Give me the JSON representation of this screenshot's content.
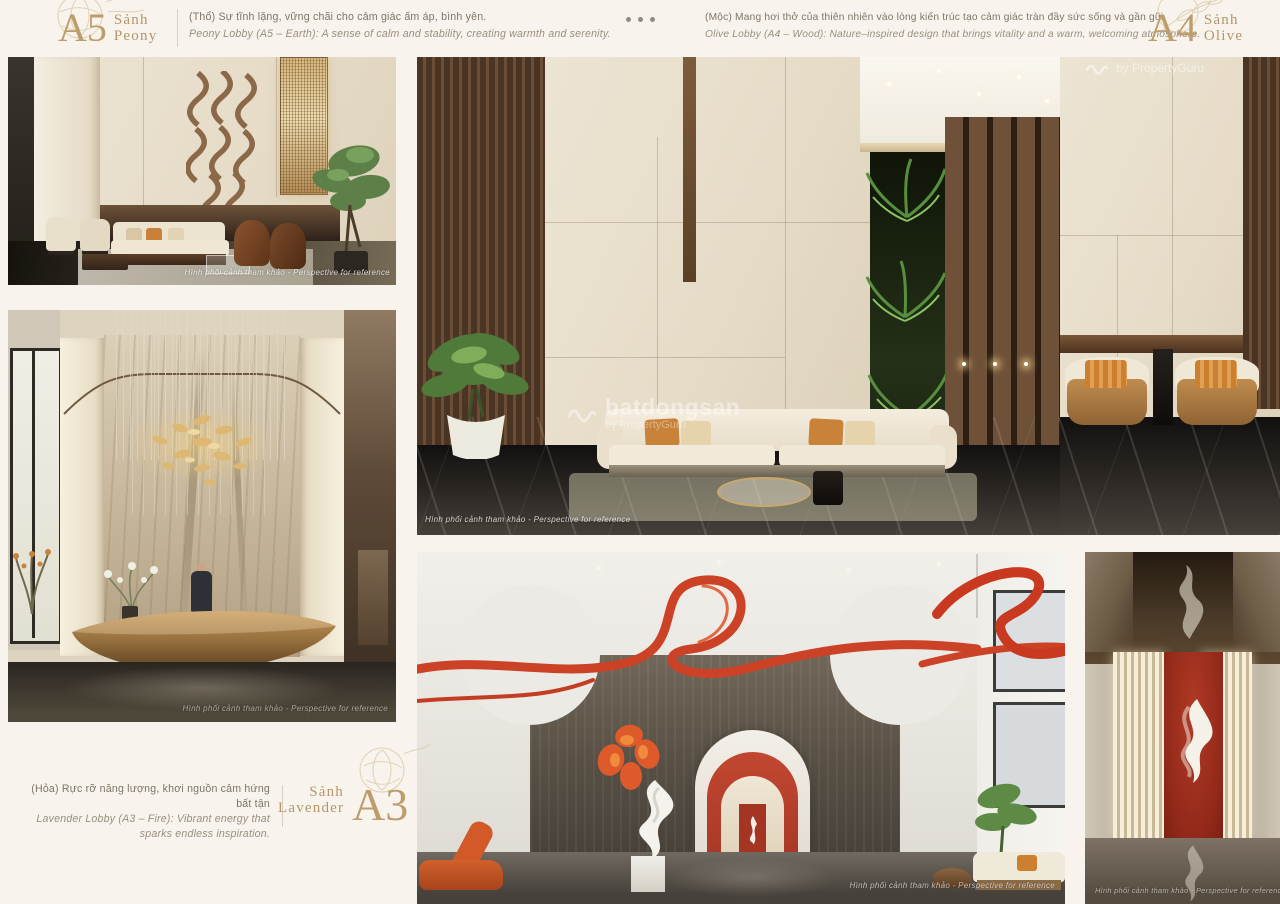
{
  "page": {
    "background": "#f8f4ed",
    "accent_gold": "#bd9d6c",
    "caption_color": "#7e7466",
    "red_accent": "#cc4429"
  },
  "lobbies": {
    "peony": {
      "code": "A5",
      "word": "Sảnh",
      "name": "Peony",
      "caption_vi": "(Thổ) Sự tĩnh lặng, vững chãi cho cảm giác ấm áp, bình yên.",
      "caption_en": "Peony Lobby (A5 – Earth): A sense of calm and stability, creating warmth and serenity."
    },
    "olive": {
      "code": "A4",
      "word": "Sảnh",
      "name": "Olive",
      "caption_vi": "(Mộc) Mang hơi thở của thiên nhiên vào lòng kiến trúc tạo cảm giác tràn đầy sức sống và gần gũi.",
      "caption_en": "Olive Lobby (A4 – Wood): Nature–inspired design that brings vitality and a warm, welcoming atmosphere."
    },
    "lavender": {
      "code": "A3",
      "word": "Sảnh",
      "name": "Lavender",
      "caption_vi": "(Hỏa) Rực rỡ năng lượng, khơi nguồn cảm hứng bất tận",
      "caption_en": "Lavender Lobby (A3 – Fire): Vibrant energy that sparks endless inspiration."
    }
  },
  "images": {
    "reference_note": "Hình phối cảnh tham khảo - Perspective for reference"
  },
  "watermark": {
    "brand": "batdongsan",
    "byline": "by PropertyGuru"
  }
}
